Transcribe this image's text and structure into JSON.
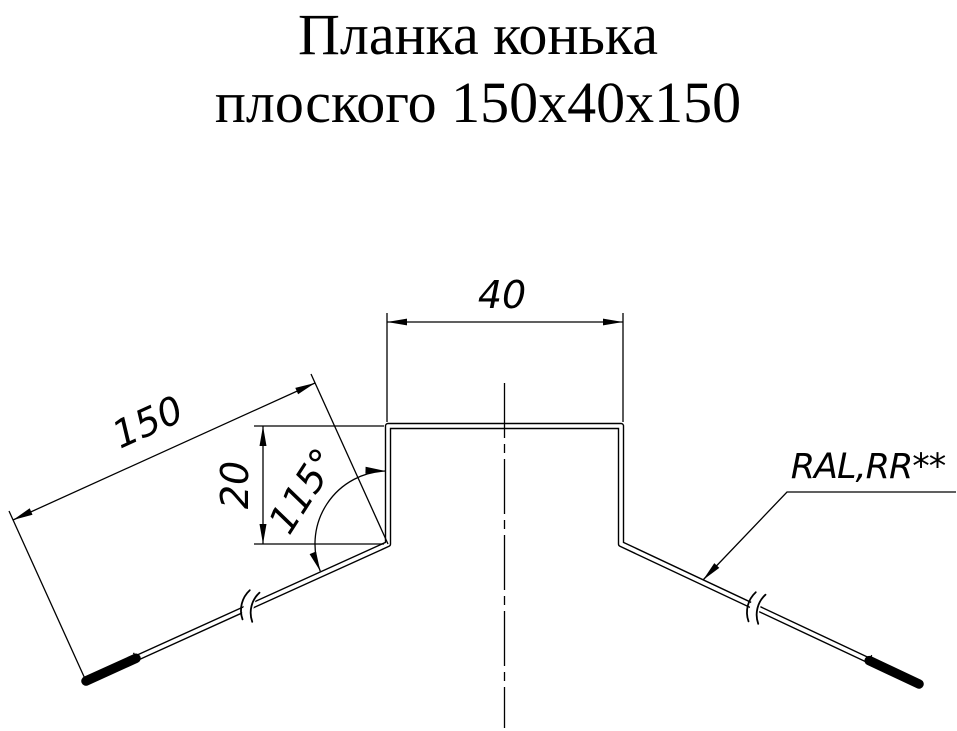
{
  "title": {
    "line1": "Планка конька",
    "line2": "плоского 150х40х150"
  },
  "dimensions": {
    "top_width": {
      "label": "40"
    },
    "wing_length": {
      "label": "150"
    },
    "rib_height": {
      "label": "20"
    },
    "bend_angle": {
      "label": "115°"
    }
  },
  "callout": {
    "coating_label": "RAL,RR**"
  },
  "colors": {
    "ink": "#000000",
    "paper": "#ffffff"
  }
}
